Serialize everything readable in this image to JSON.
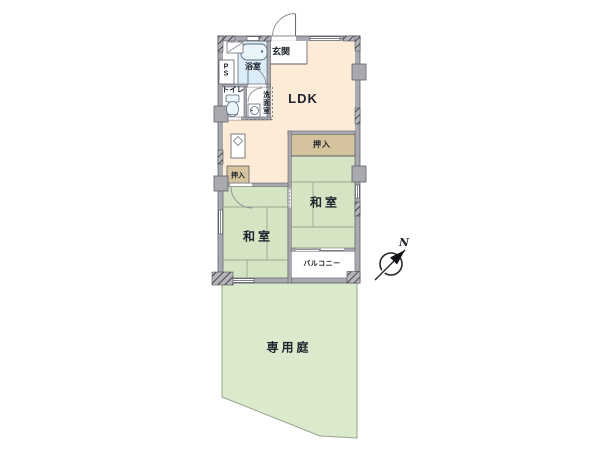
{
  "labels": {
    "genkan": "玄関",
    "bath": "浴室",
    "pipe_space": "P\nS",
    "toilet": "トイレ",
    "washroom": "洗面室",
    "ldk": "LDK",
    "closet_right": "押入",
    "closet_left": "押入",
    "japanese_room_right": "和室",
    "japanese_room_left": "和室",
    "balcony": "バルコニー",
    "private_garden": "専用庭",
    "compass_north": "N"
  },
  "colors": {
    "ldk_floor": "#fcebd6",
    "tatami_green": "#d5e4c3",
    "garden_green": "#dbe9cc",
    "closet_tan": "#d5c39d",
    "water_blue": "#d9ecf7",
    "fixture_blue": "#eaf4fb",
    "wall_gray": "#a9a9b0",
    "line_dark": "#50545e",
    "text_dark": "#20242e"
  }
}
